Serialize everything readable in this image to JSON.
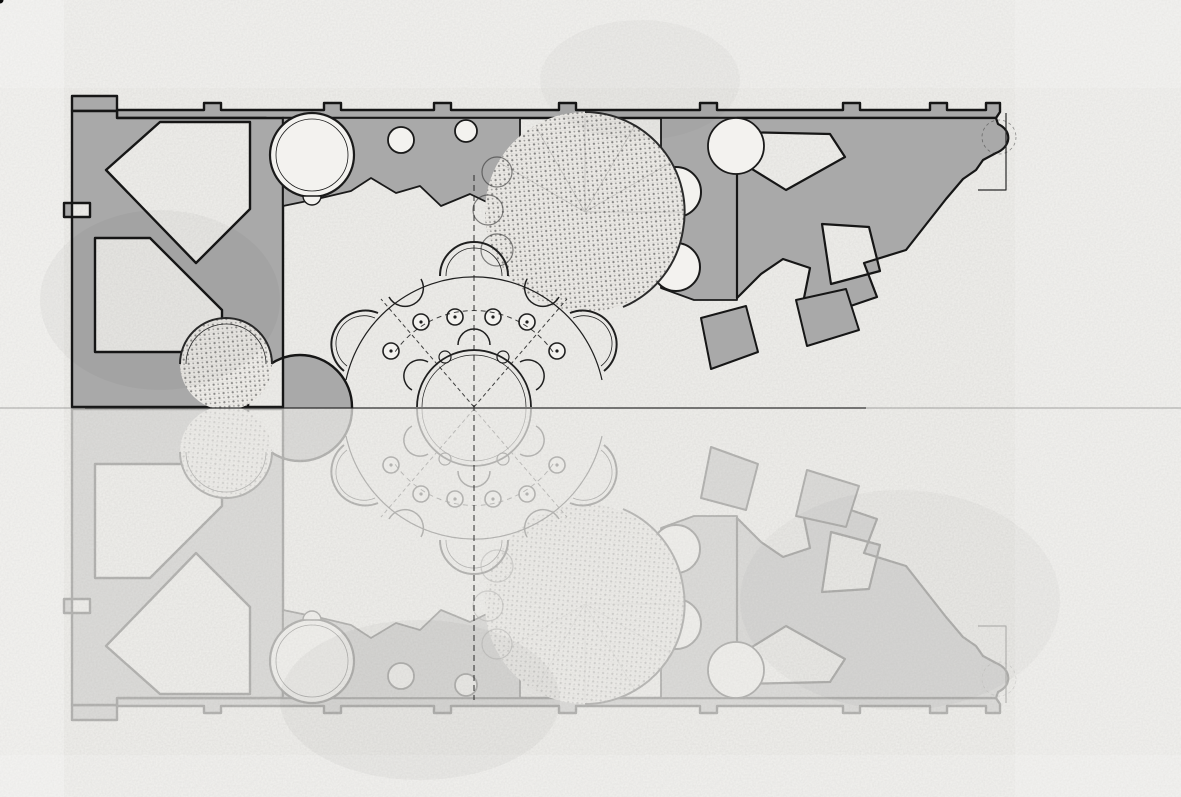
{
  "meta": {
    "title": "geometric-analysis-architectural-plan",
    "subject": "baroque church plan with six-pointed star overlay and triangular construction grid",
    "canvas": {
      "width": 1181,
      "height": 797
    },
    "mirror_axis_y": 408
  },
  "colors": {
    "paper": "#f1f0ed",
    "paper_room": "#f3f2ef",
    "poche": "#a9a9a9",
    "outline": "#161616",
    "ghost_opacity": 0.26,
    "grid_upper": "#2e2e2e",
    "grid_lower": "#141414",
    "band_core": "#6d6d6d",
    "band_edge": "#2d2d2d",
    "glyph": "#5c5c5c",
    "construction": "#1a1a1a"
  },
  "hexagram": {
    "center": [
      474,
      407
    ],
    "triangle_a": [
      [
        862,
        407
      ],
      [
        280,
        73
      ],
      [
        283,
        741
      ]
    ],
    "triangle_b": [
      [
        661,
        75
      ],
      [
        87,
        408
      ],
      [
        659,
        738
      ]
    ],
    "star_outline": [
      [
        862,
        407
      ],
      [
        661,
        292
      ],
      [
        661,
        75
      ],
      [
        473,
        184
      ],
      [
        280,
        73
      ],
      [
        281,
        295
      ],
      [
        87,
        408
      ],
      [
        282,
        520
      ],
      [
        283,
        741
      ],
      [
        474,
        631
      ],
      [
        659,
        738
      ],
      [
        660,
        523
      ]
    ],
    "thick_band": [
      [
        137,
        437
      ],
      [
        282,
        520
      ],
      [
        283,
        741
      ],
      [
        474,
        631
      ],
      [
        659,
        738
      ],
      [
        660,
        523
      ],
      [
        855,
        409
      ],
      [
        788,
        366
      ]
    ],
    "edge_extension": 0.09
  },
  "grid": {
    "center_x": 474,
    "mirror_y": 408,
    "row_height": 46.77,
    "diag_step": 54,
    "vert_step": 46.77,
    "k_row": 8,
    "k_diag": 9,
    "k_vert": 9,
    "upper_dash": "5,4",
    "lower_vert_dash": "7,4",
    "upper_width": 0.9,
    "lower_width": 1.7,
    "vert_width": 1.4
  },
  "faint_grid": {
    "spacing": 47,
    "offset_x": 27,
    "offset_y": 13,
    "opacity": 0.05
  },
  "vanishing_point": {
    "pos": [
      1132,
      407
    ],
    "ray_angles_deg": [
      -55,
      -45,
      -36,
      -28,
      -21,
      -15,
      -10,
      -5,
      5,
      10,
      15,
      21,
      28,
      36,
      45,
      55
    ],
    "ray_length": 545,
    "arc_radii": [
      150,
      224,
      305
    ],
    "arc_opacity": [
      0.07,
      0.11,
      0.08
    ]
  },
  "center_fan": {
    "cx": 474,
    "cy": 407,
    "r": 57,
    "angles_deg": [
      15,
      30,
      45,
      60,
      75,
      105,
      120,
      135,
      150,
      165
    ]
  },
  "glyph_star": [
    [
      474,
      403
    ],
    [
      511,
      424
    ],
    [
      521,
      441
    ],
    [
      493,
      439
    ],
    [
      474,
      476
    ],
    [
      455,
      439
    ],
    [
      427,
      441
    ],
    [
      437,
      424
    ]
  ],
  "speckles": [
    [
      75,
      12,
      2,
      0.5
    ],
    [
      118,
      36,
      1.5,
      0.45
    ],
    [
      264,
      27,
      1.5,
      0.4
    ],
    [
      352,
      88,
      2.5,
      0.55
    ],
    [
      948,
      60,
      2,
      0.5
    ],
    [
      1143,
      57,
      2,
      0.55
    ],
    [
      660,
      41,
      1.5,
      0.4
    ],
    [
      731,
      18,
      1.5,
      0.35
    ],
    [
      360,
      262,
      2.5,
      0.5
    ],
    [
      110,
      208,
      1.5,
      0.4
    ],
    [
      46,
      341,
      2,
      0.45
    ],
    [
      351,
      264,
      1.5,
      0.5
    ],
    [
      87,
      641,
      2.5,
      0.5
    ],
    [
      302,
      561,
      2,
      0.45
    ],
    [
      611,
      659,
      2.5,
      0.5
    ],
    [
      1020,
      469,
      2,
      0.45
    ],
    [
      1121,
      741,
      2.5,
      0.5
    ],
    [
      434,
      760,
      2,
      0.45
    ],
    [
      534,
      785,
      1.5,
      0.4
    ],
    [
      686,
      782,
      2,
      0.45
    ],
    [
      942,
      679,
      1.5,
      0.4
    ],
    [
      1050,
      600,
      1.5,
      0.35
    ],
    [
      260,
      702,
      2,
      0.4
    ],
    [
      180,
      760,
      1.5,
      0.4
    ],
    [
      1080,
      342,
      1.5,
      0.4
    ],
    [
      908,
      421,
      1.5,
      0.45
    ],
    [
      560,
      430,
      1.5,
      0.35
    ],
    [
      60,
      500,
      1.5,
      0.35
    ],
    [
      18,
      270,
      1.5,
      0.4
    ],
    [
      990,
      530,
      1.5,
      0.3
    ],
    [
      228,
      487,
      2,
      0.4
    ],
    [
      700,
      560,
      1.5,
      0.35
    ],
    [
      820,
      120,
      1.5,
      0.4
    ],
    [
      500,
      300,
      1.5,
      0.35
    ]
  ],
  "construction_lines": [
    [
      150,
      0,
      345,
      195
    ],
    [
      305,
      0,
      140,
      165
    ],
    [
      540,
      0,
      770,
      230
    ],
    [
      830,
      0,
      1010,
      190
    ],
    [
      0,
      90,
      255,
      90
    ],
    [
      1090,
      0,
      1090,
      200
    ],
    [
      877,
      118,
      877,
      408
    ],
    [
      0,
      620,
      290,
      797
    ],
    [
      0,
      755,
      430,
      650
    ],
    [
      80,
      797,
      430,
      610
    ],
    [
      700,
      797,
      1010,
      610
    ]
  ]
}
